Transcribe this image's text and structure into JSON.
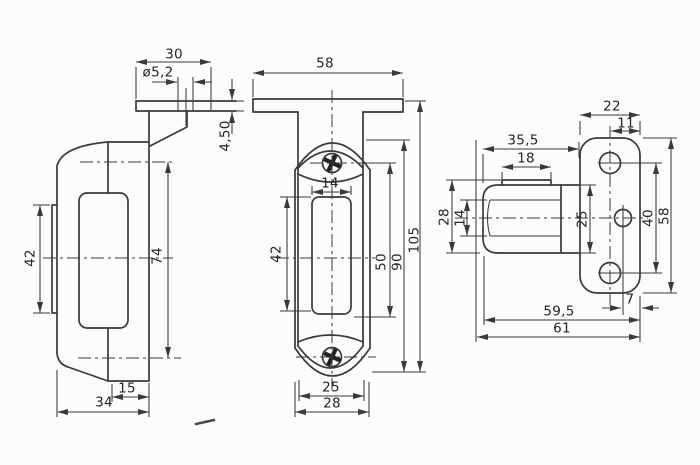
{
  "colors": {
    "line": "#3a3a3a",
    "background": "#fcfcfb",
    "text": "#252525"
  },
  "views": {
    "side": {
      "flange_width": "30",
      "hole_diameter": "ø5,2",
      "flange_thickness": "4,50",
      "lens_height": "42",
      "hole_spacing": "74",
      "foot_depth": "15",
      "body_depth": "34"
    },
    "front": {
      "flange_width": "58",
      "window_width": "14",
      "window_height": "42",
      "screw_to_window": "50",
      "body_height": "90",
      "overall_height": "105",
      "lens_width": "25",
      "body_width": "28"
    },
    "top": {
      "plate_width": "22",
      "hole_inset": "11",
      "body_length": "35,5",
      "lens_length": "18",
      "body_depth": "28",
      "window_depth": "14",
      "body_height": "25",
      "hole_spacing": "40",
      "plate_length": "58",
      "hole_edge_offset": "7",
      "body_to_plate_end": "59,5",
      "overall_length": "61"
    }
  }
}
